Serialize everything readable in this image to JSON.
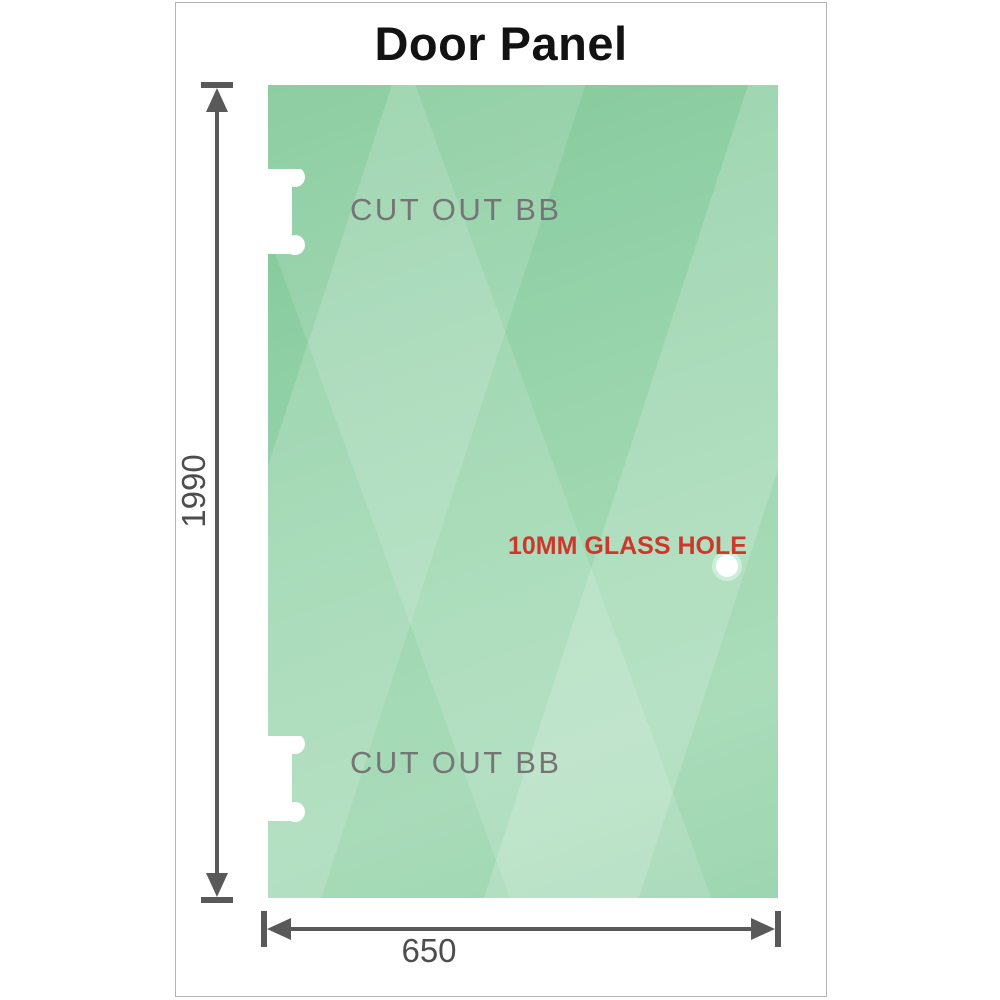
{
  "title": "Door Panel",
  "panel": {
    "glass_color": "#93d2a8",
    "cutouts": [
      {
        "position": "top-left",
        "label": "CUT OUT BB"
      },
      {
        "position": "bottom-left",
        "label": "CUT OUT BB"
      }
    ],
    "hole": {
      "label": "10MM GLASS HOLE"
    }
  },
  "dimensions": {
    "height": {
      "label": "1990"
    },
    "width": {
      "label": "650"
    }
  },
  "colors": {
    "title_text": "#121212",
    "dimension_line": "#595959",
    "dimension_text": "#4d4d4d",
    "cutout_label_text": "#757575",
    "hole_label_text": "#cd382c",
    "frame_border": "#b3b3b3"
  }
}
